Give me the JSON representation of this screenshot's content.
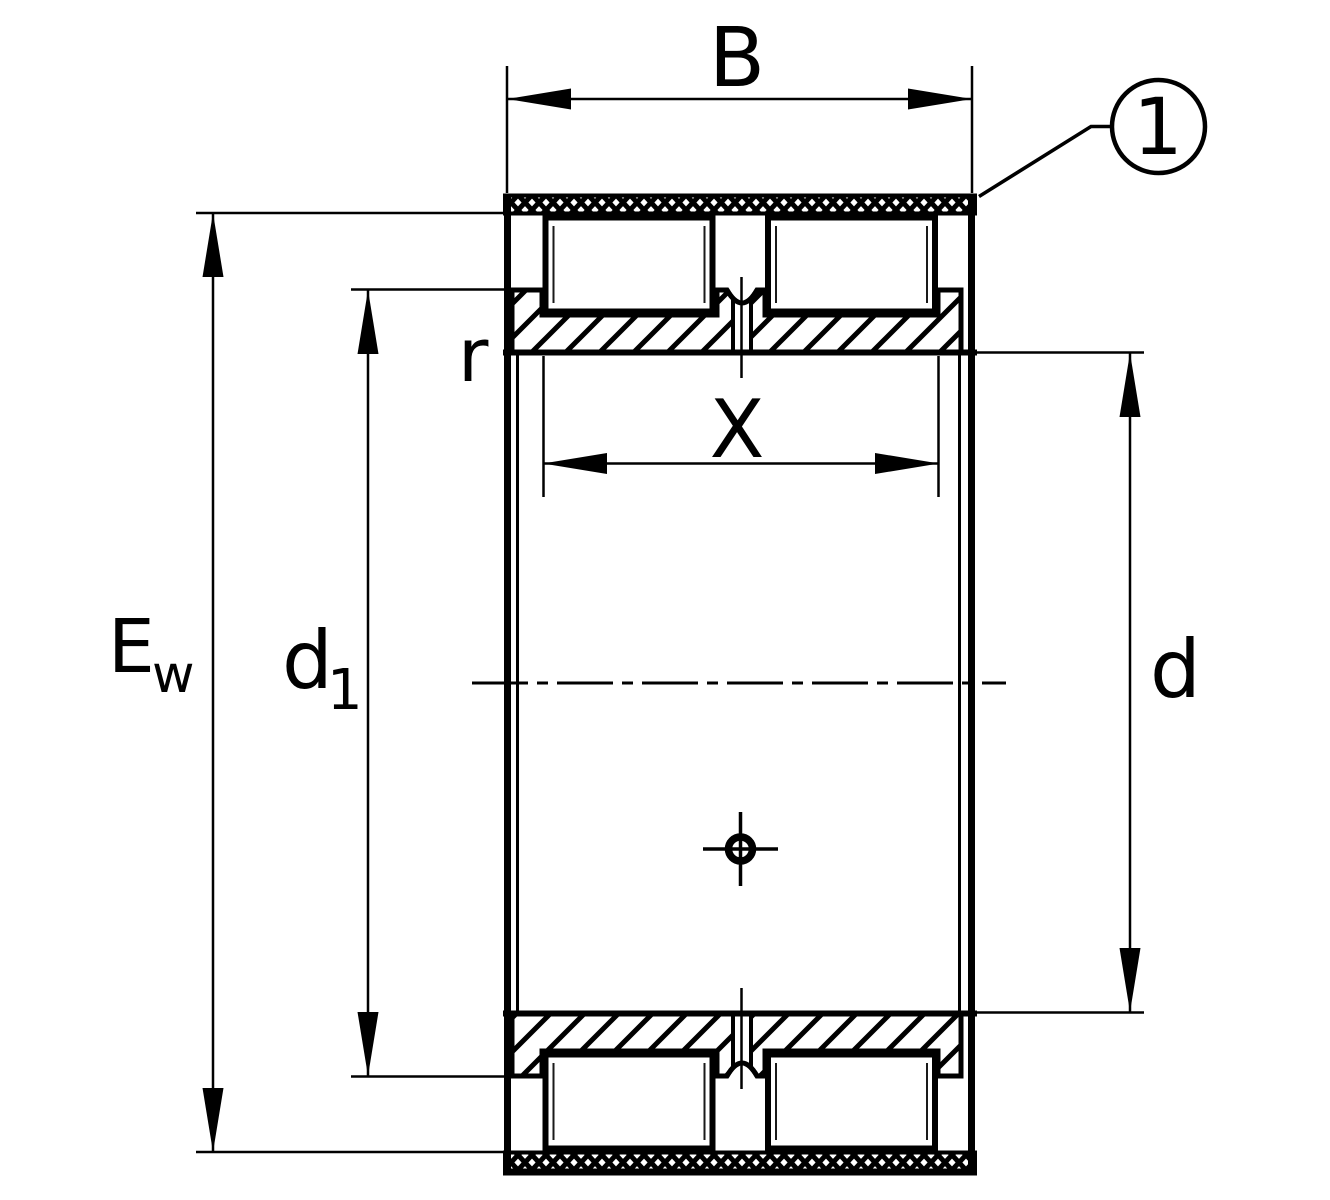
{
  "figure": {
    "type": "technical-sectional-drawing",
    "subject": "double-row full-complement cylindrical roller bearing with lubrication groove and hole",
    "background_color": "#ffffff",
    "line_color": "#000000"
  },
  "labels": {
    "B": "B",
    "X": "X",
    "r": "r",
    "Ew_main": "E",
    "Ew_sub": "w",
    "d1_main": "d",
    "d1_sub": "1",
    "d": "d",
    "callout_1": "1"
  }
}
